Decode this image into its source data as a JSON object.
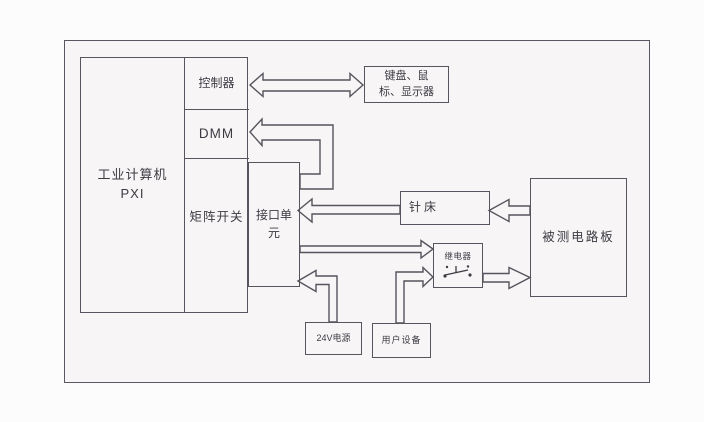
{
  "colors": {
    "line": "#56545c",
    "text": "#3d3b42",
    "frame_background": "#f7f5f6",
    "page_background": "#fdfcfc"
  },
  "nodes": {
    "industrial_computer": {
      "label": "工业计算机\nPXI"
    },
    "controller": {
      "label": "控制器"
    },
    "dmm": {
      "label": "DMM"
    },
    "matrix_switch": {
      "label": "矩阵开关"
    },
    "interface_unit": {
      "label": "接口单\n元"
    },
    "keyboard_mouse_display": {
      "label": "键盘、鼠\n标、显示器"
    },
    "needle_bed": {
      "label": "针床"
    },
    "dut_board": {
      "label": "被测电路板"
    },
    "relay": {
      "label": "继电器"
    },
    "power_24v": {
      "label": "24V电源"
    },
    "user_equipment": {
      "label": "用户设备"
    }
  },
  "connections": [
    {
      "from": "控制器",
      "to": "键盘、鼠标、显示器",
      "direction": "bidirectional"
    },
    {
      "from": "接口单元",
      "to": "DMM",
      "direction": "one-way"
    },
    {
      "from": "针床",
      "to": "接口单元",
      "direction": "one-way"
    },
    {
      "from": "被测电路板",
      "to": "针床",
      "direction": "one-way"
    },
    {
      "from": "接口单元",
      "to": "继电器",
      "direction": "one-way"
    },
    {
      "from": "24V电源",
      "to": "接口单元",
      "direction": "one-way"
    },
    {
      "from": "用户设备",
      "to": "继电器",
      "direction": "one-way"
    },
    {
      "from": "继电器",
      "to": "被测电路板",
      "direction": "one-way"
    }
  ]
}
